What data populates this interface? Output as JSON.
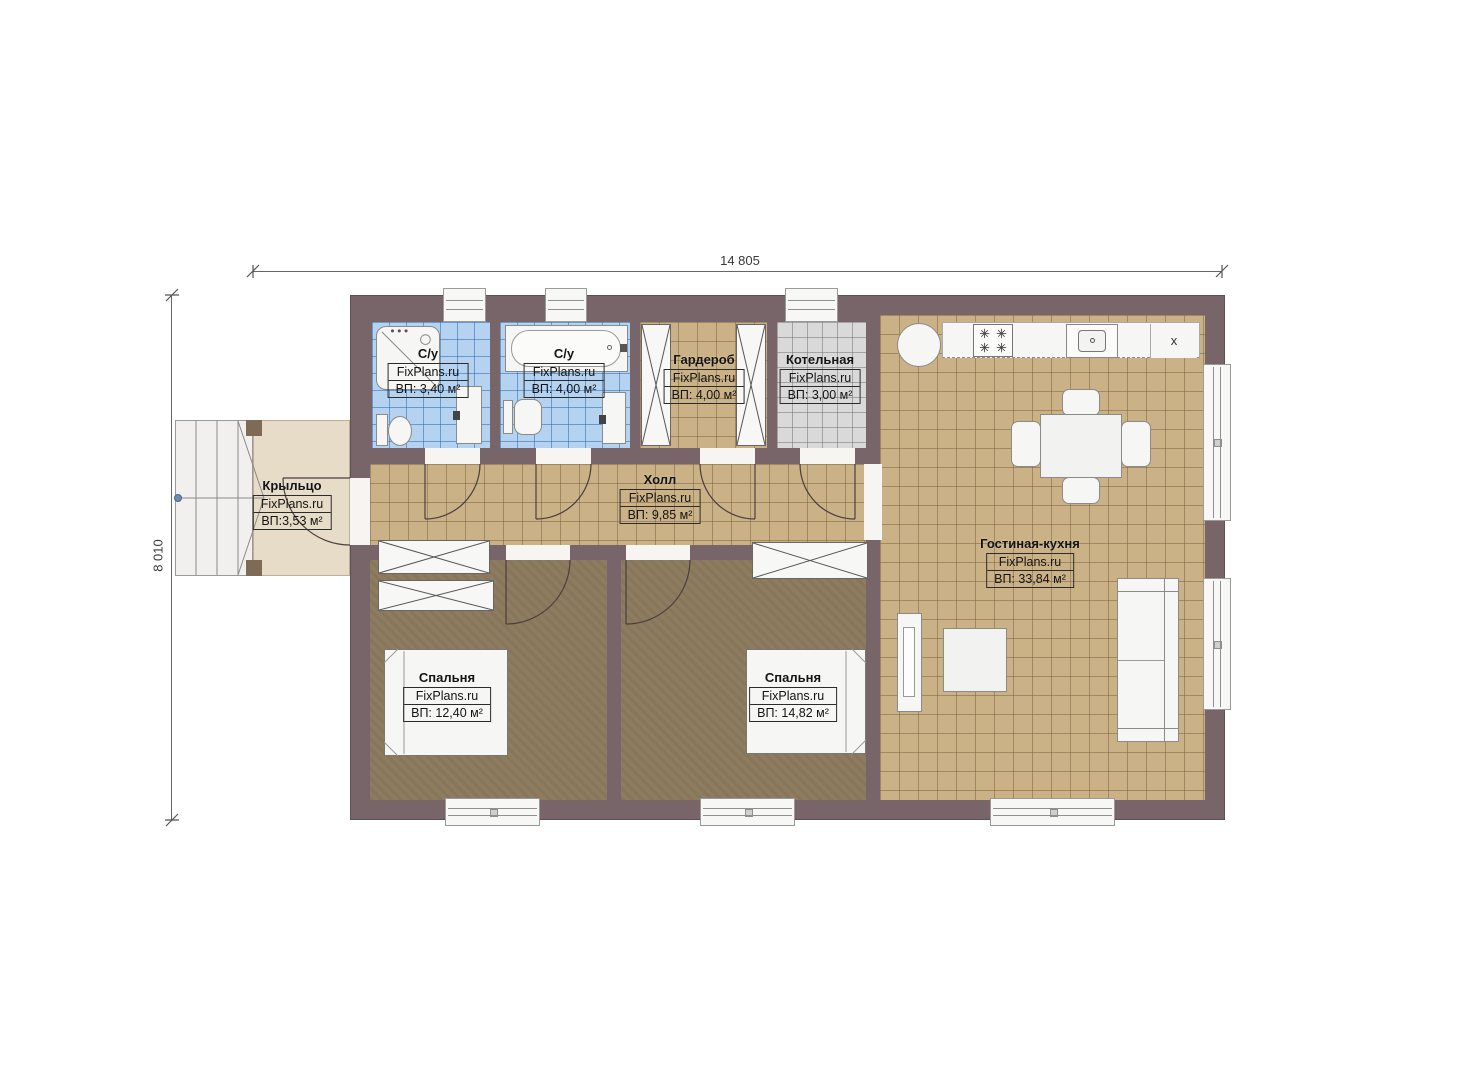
{
  "plan": {
    "brand": "FixPlans.ru",
    "dimensions": {
      "width": "14 805",
      "height": "8 010"
    },
    "rooms": {
      "bath1": {
        "name": "С/у",
        "area": "ВП: 3,40 м²"
      },
      "bath2": {
        "name": "С/у",
        "area": "ВП: 4,00 м²"
      },
      "wardrobe": {
        "name": "Гардероб",
        "area": "ВП: 4,00 м²"
      },
      "boiler": {
        "name": "Котельная",
        "area": "ВП: 3,00 м²"
      },
      "porch": {
        "name": "Крыльцо",
        "area": "ВП:3,53 м²"
      },
      "hall": {
        "name": "Холл",
        "area": "ВП: 9,85 м²"
      },
      "living": {
        "name": "Гостиная-кухня",
        "area": "ВП: 33,84 м²"
      },
      "bedroom1": {
        "name": "Спальня",
        "area": "ВП: 12,40 м²"
      },
      "bedroom2": {
        "name": "Спальня",
        "area": "ВП: 14,82 м²"
      }
    },
    "kitchen": {
      "cabinet_mark": "x"
    },
    "colors": {
      "wall": "#786569",
      "tile": "#cbb186",
      "bedroom_floor": "#8d7c5f",
      "bath_tile": "#b5d3f0",
      "boiler_tile": "#d9d9d9",
      "porch": "#e7dcc7"
    }
  }
}
